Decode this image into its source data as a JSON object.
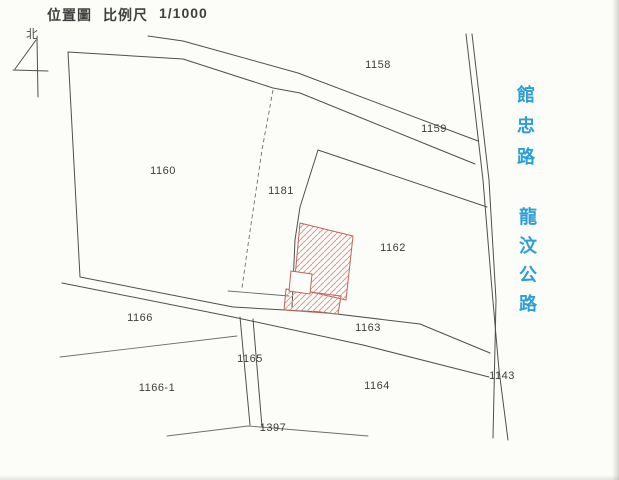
{
  "header": {
    "map_type": "位置圖",
    "scale_label": "比例尺",
    "scale_value": "1/1000"
  },
  "north": {
    "label": "北"
  },
  "roads": {
    "guanzhong": {
      "name": "館忠路"
    },
    "longwen": {
      "name": "龍汶公路"
    }
  },
  "parcels": [
    {
      "id": "1158"
    },
    {
      "id": "1159"
    },
    {
      "id": "1160"
    },
    {
      "id": "1181"
    },
    {
      "id": "1162"
    },
    {
      "id": "1166"
    },
    {
      "id": "1163"
    },
    {
      "id": "1165"
    },
    {
      "id": "1166-1"
    },
    {
      "id": "1164"
    },
    {
      "id": "1143"
    },
    {
      "id": "1397"
    }
  ],
  "building": {
    "role": "subject-building-footprint",
    "outline_color": "#c0655c",
    "hatch_color": "#d99a92"
  },
  "colors": {
    "boundary_line": "#4f4f4c",
    "road_text": "#2ba0d6",
    "paper": "#fcfcf9",
    "label_text": "#3d3d3d"
  }
}
